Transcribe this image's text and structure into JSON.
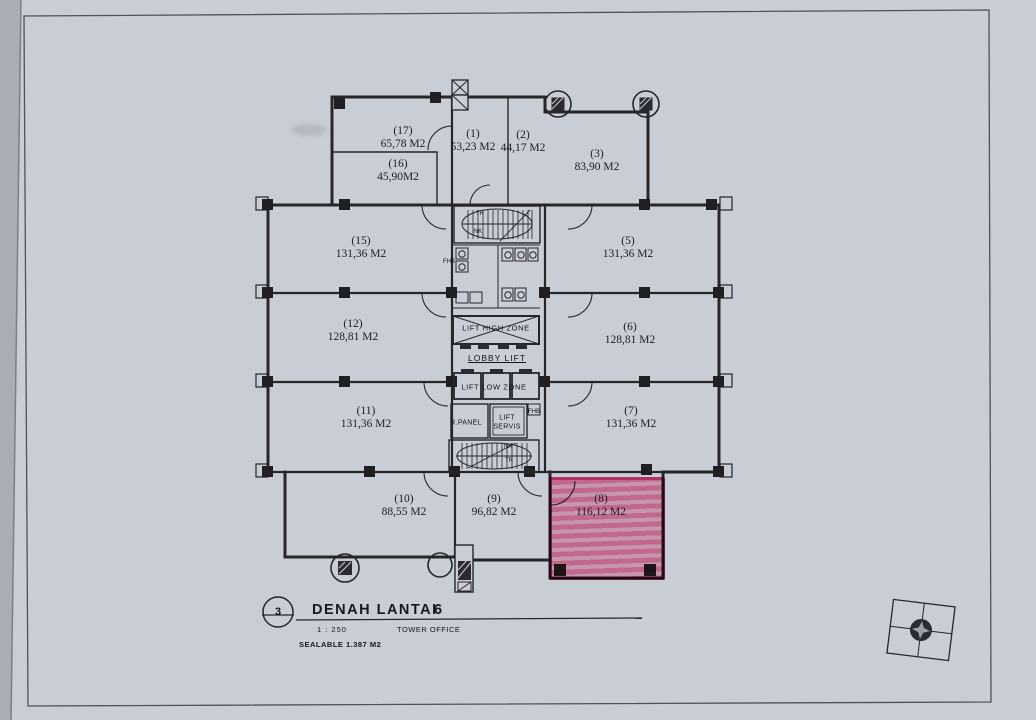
{
  "title_block": {
    "detail_number": "3",
    "title": "DENAH LANTAI",
    "floor_number": "6",
    "scale": "1 : 250",
    "building_name": "TOWER OFFICE",
    "saleable_area": "SEALABLE 1.387 M2"
  },
  "units": [
    {
      "id": "17",
      "label": "(17)",
      "area": "65,78 M2",
      "highlighted": false
    },
    {
      "id": "16",
      "label": "(16)",
      "area": "45,90M2",
      "highlighted": false
    },
    {
      "id": "1",
      "label": "(1)",
      "area": "53,23 M2",
      "highlighted": false
    },
    {
      "id": "2",
      "label": "(2)",
      "area": "44,17 M2",
      "highlighted": false
    },
    {
      "id": "3",
      "label": "(3)",
      "area": "83,90 M2",
      "highlighted": false
    },
    {
      "id": "15",
      "label": "(15)",
      "area": "131,36 M2",
      "highlighted": false
    },
    {
      "id": "12",
      "label": "(12)",
      "area": "128,81 M2",
      "highlighted": false
    },
    {
      "id": "11",
      "label": "(11)",
      "area": "131,36 M2",
      "highlighted": false
    },
    {
      "id": "5",
      "label": "(5)",
      "area": "131,36 M2",
      "highlighted": false
    },
    {
      "id": "6",
      "label": "(6)",
      "area": "128,81 M2",
      "highlighted": false
    },
    {
      "id": "7",
      "label": "(7)",
      "area": "131,36 M2",
      "highlighted": false
    },
    {
      "id": "10",
      "label": "(10)",
      "area": "88,55 M2",
      "highlighted": false
    },
    {
      "id": "9",
      "label": "(9)",
      "area": "96,82 M2",
      "highlighted": false
    },
    {
      "id": "8",
      "label": "(8)",
      "area": "116,12 M2",
      "highlighted": true
    }
  ],
  "core_labels": {
    "stair_top_tr": "TR",
    "stair_top_nk": "NK",
    "fhb_left": "FHB",
    "lift_high_zone": "LIFT HIGH ZONE",
    "lobby_lift": "LOBBY LIFT",
    "lift_low_zone": "LIFT LOW ZONE",
    "panel_room": "R.PANEL",
    "lift_service_line1": "LIFT",
    "lift_service_line2": "SERVIS",
    "fhb_right": "FHB",
    "stair_bottom_nk": "NK",
    "stair_bottom_tr": "TR"
  },
  "highlight": {
    "unit_id": "8",
    "fill_color": "#f679a6",
    "border_color": "#e33d7b"
  },
  "colors": {
    "paper": "#c9cdd5",
    "ink": "#26262b"
  },
  "icons": {
    "compass": "compass-rose-icon"
  }
}
